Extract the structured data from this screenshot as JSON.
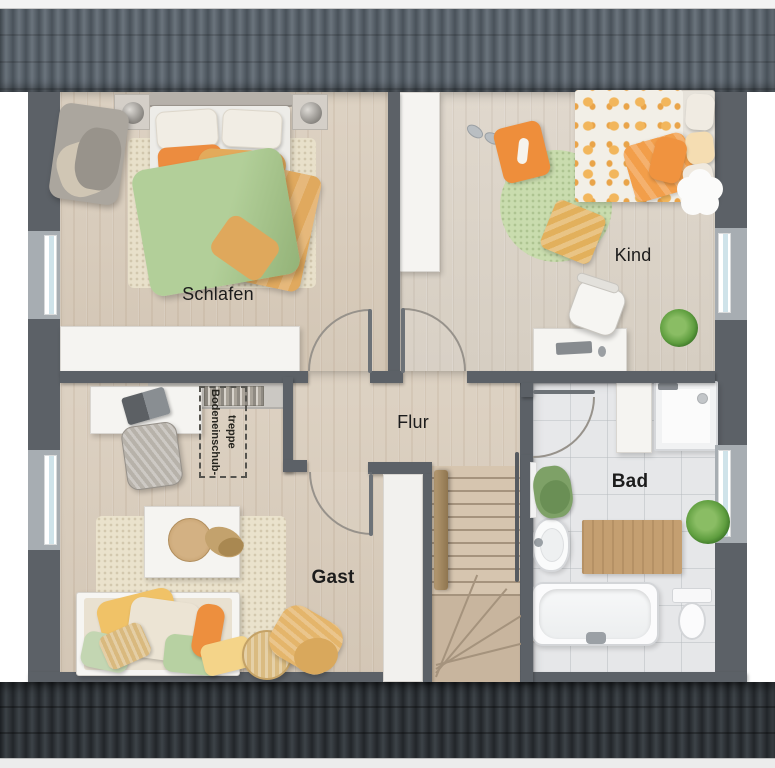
{
  "plan": {
    "rooms": {
      "schlafen": {
        "label": "Schlafen"
      },
      "kind": {
        "label": "Kind"
      },
      "flur": {
        "label": "Flur"
      },
      "gast": {
        "label": "Gast"
      },
      "bad": {
        "label": "Bad"
      }
    },
    "annotations": {
      "attic_hatch": {
        "label": "Bodeneinschub-\ntreppe"
      }
    },
    "colors": {
      "roof_top": "#565f68",
      "roof_bottom": "#2e3337",
      "wall": "#5c6167",
      "wood_floor": "#dbcfc0",
      "tile_floor": "#e6e7e9",
      "stair_wood": "#cdbba5",
      "accent_orange": "#ee8f3d",
      "accent_yellow": "#e9b765",
      "accent_green": "#a9c791",
      "window_glass": "#cfe3ea",
      "label_text": "#1c1c1c"
    }
  }
}
